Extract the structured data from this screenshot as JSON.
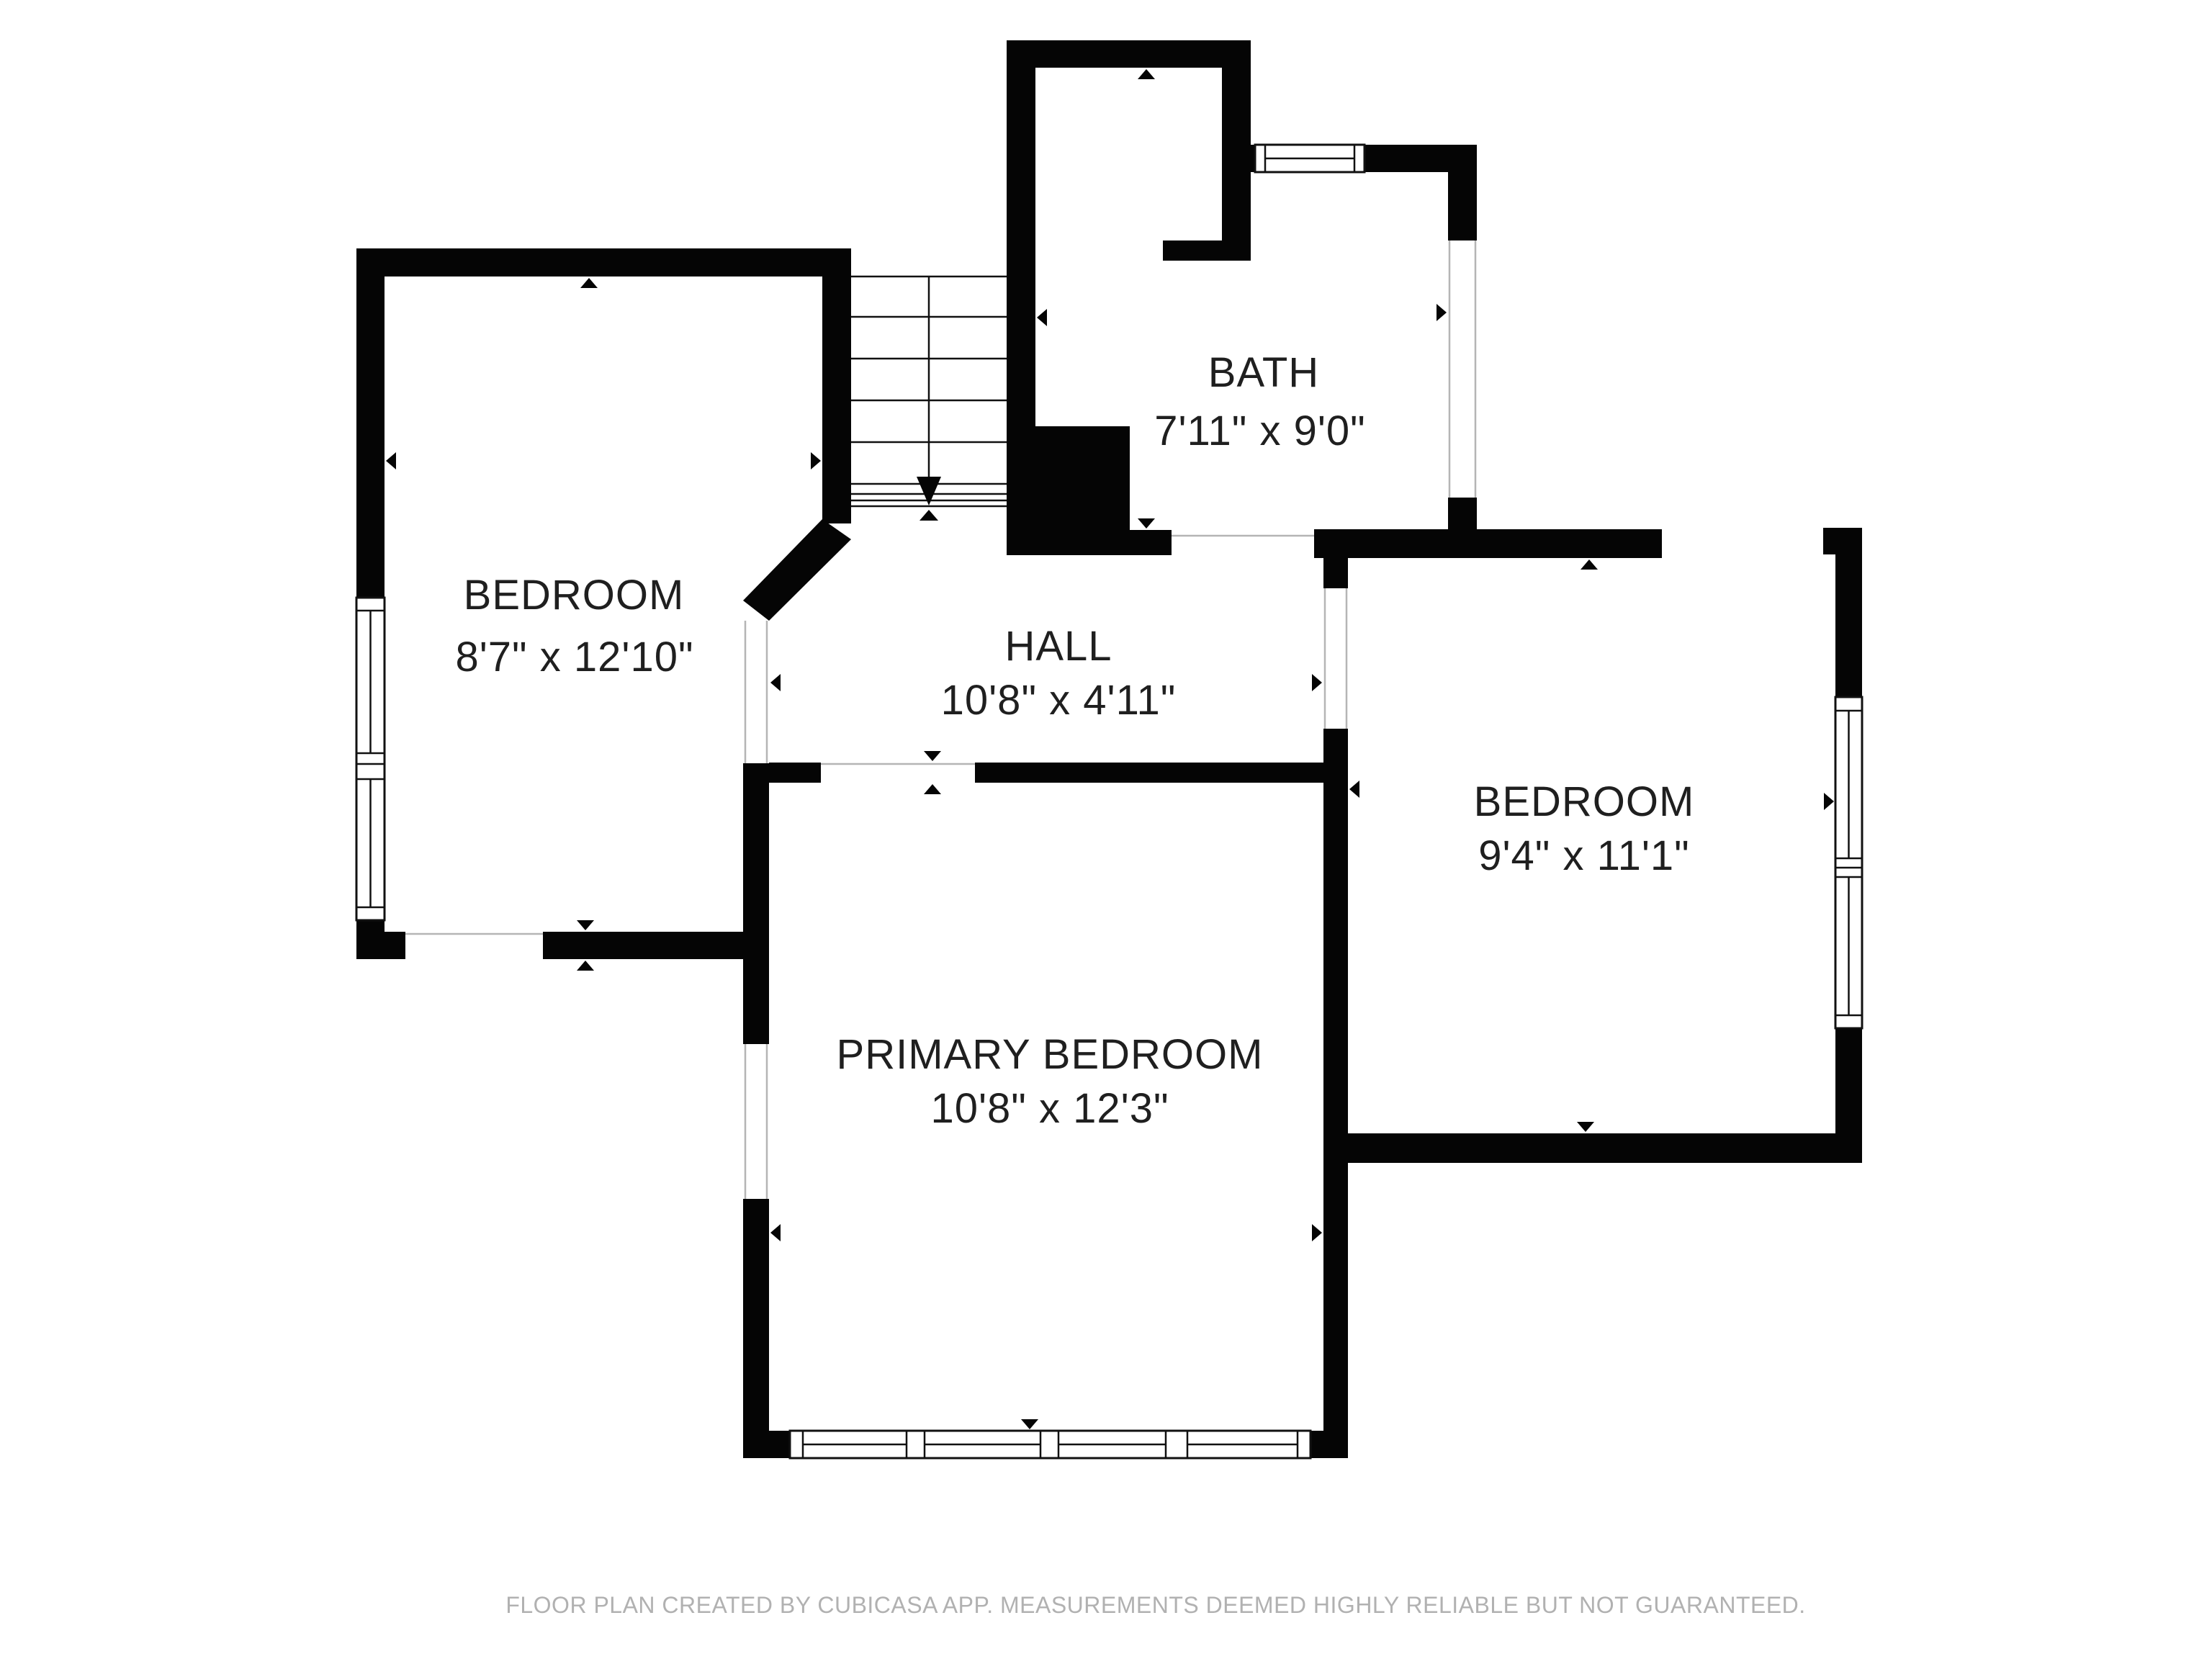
{
  "plan": {
    "creator_note": "FLOOR PLAN CREATED BY CUBICASA APP. MEASUREMENTS DEEMED HIGHLY RELIABLE BUT NOT GUARANTEED.",
    "rooms": [
      {
        "name": "BEDROOM",
        "dims": "8'7\" x 12'10\""
      },
      {
        "name": "BATH",
        "dims": "7'11\" x 9'0\""
      },
      {
        "name": "HALL",
        "dims": "10'8\" x 4'11\""
      },
      {
        "name": "BEDROOM",
        "dims": "9'4\" x 11'1\""
      },
      {
        "name": "PRIMARY BEDROOM",
        "dims": "10'8\" x 12'3\""
      }
    ],
    "features": {
      "stairs": "stairs-with-down-arrow",
      "markers": "wall-extent-arrow-icons",
      "windows": "framed-windows-with-center-line",
      "doors": "open-white-gaps"
    },
    "colors": {
      "wall": "#050505",
      "room_text": "#1f1f1f",
      "footer_text": "#b1b1b1",
      "background": "#ffffff"
    }
  }
}
